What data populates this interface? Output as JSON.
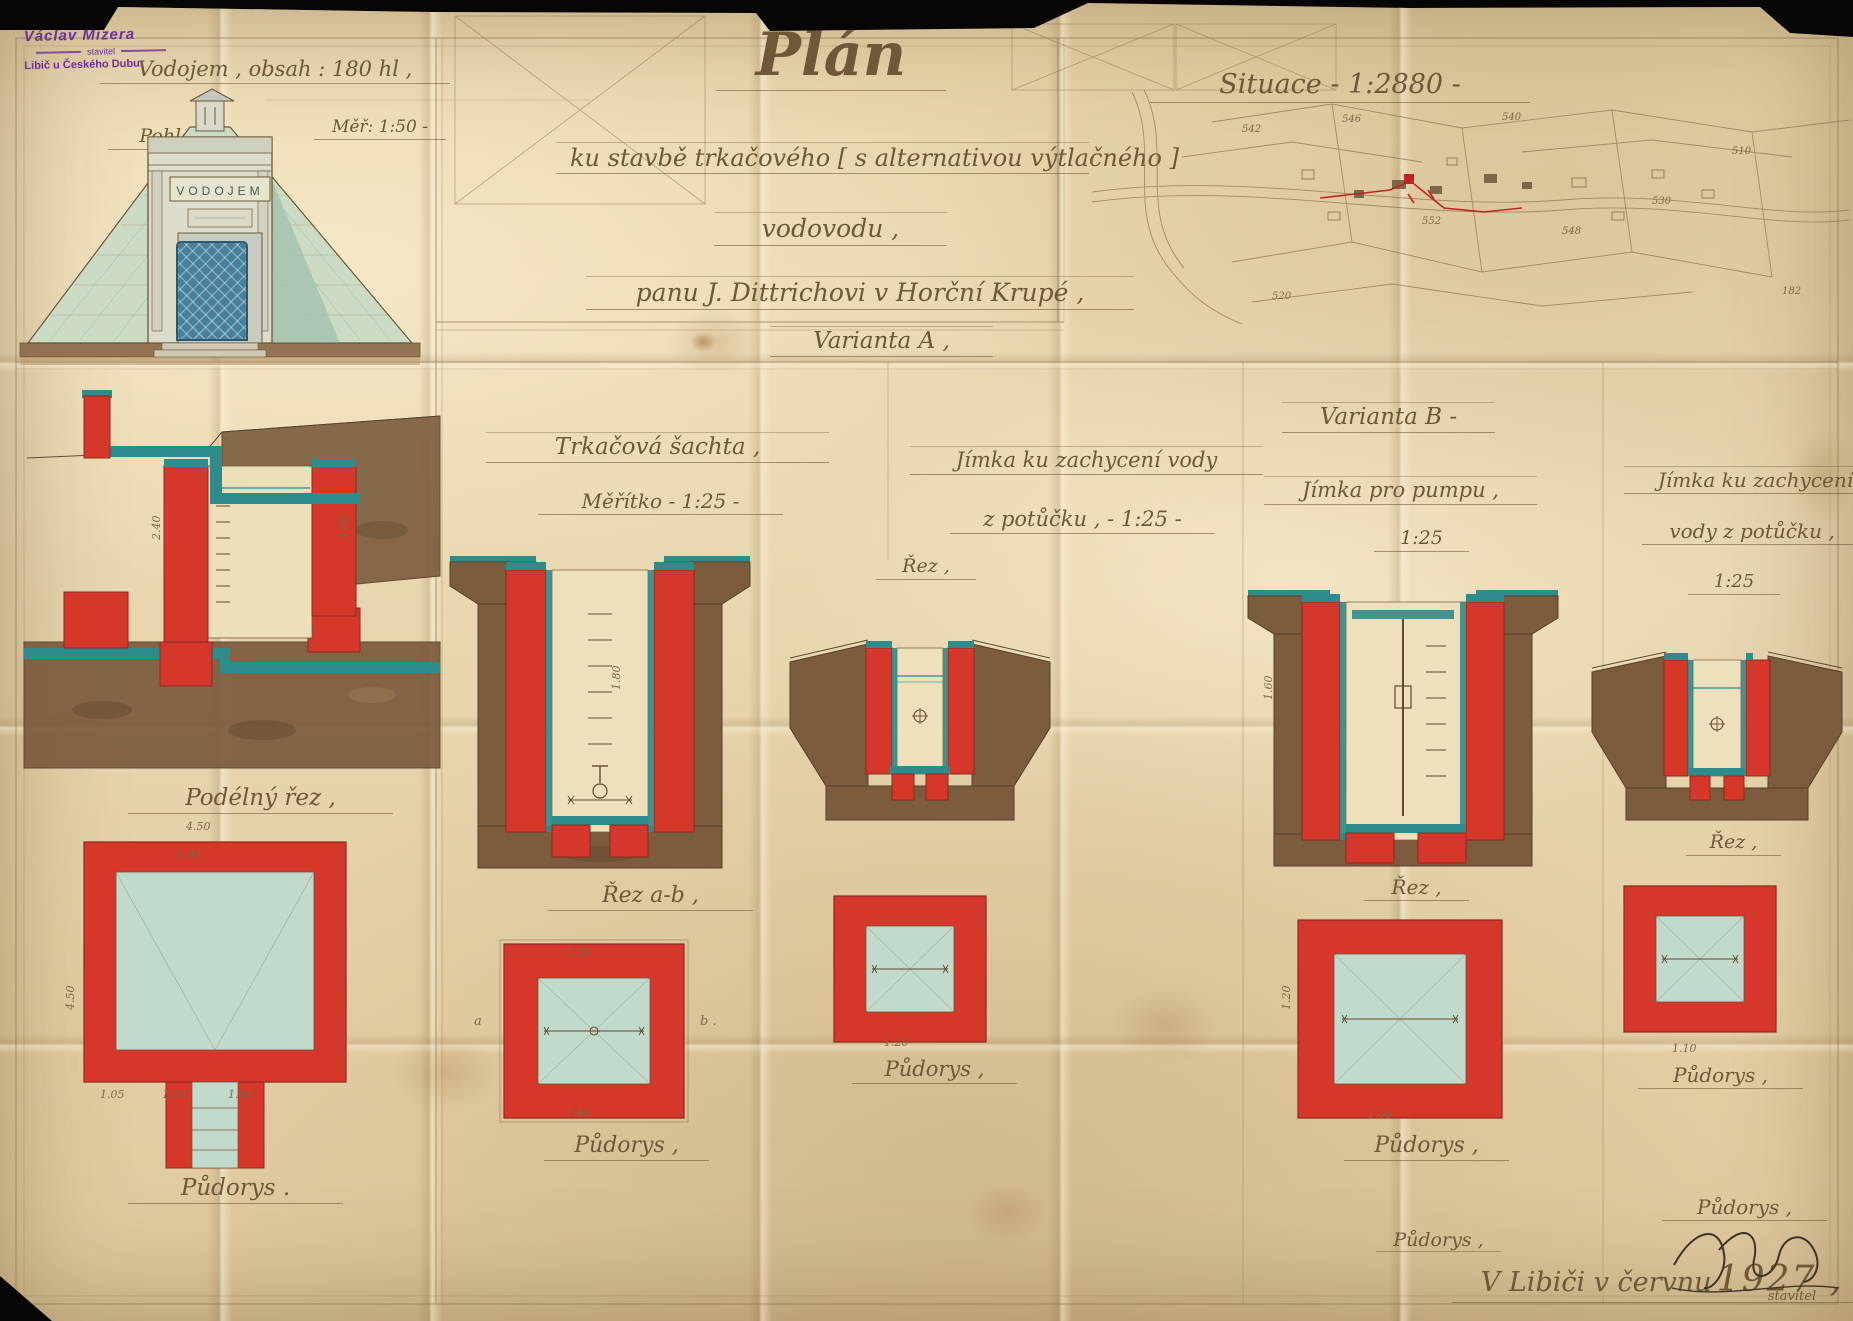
{
  "colors": {
    "red": "#d5382a",
    "teal": "#2f8c8c",
    "brown": "#7b5c3c",
    "interior_blue": "#c2dacc",
    "ink": "#6b573a",
    "stamp_violet": "#6d2f9e",
    "paper": "#e9d7b0"
  },
  "stamp": {
    "name": "Václav Mizera",
    "role": "stavitel",
    "place": "Libič u Českého Dubu."
  },
  "header_left": {
    "line1": "Vodojem , obsah : 180 hl ,",
    "line2": "Pohled ,",
    "scale": "Měř: 1:50 -",
    "sign": "VODOJEM"
  },
  "title_block": {
    "title": "Plán",
    "line1": "ku stavbě trkačového [ s alternativou výtlačného ]",
    "line2": "vodovodu ,",
    "line3": "panu J. Dittrichovi v Horční Krupé ,",
    "variant_a": "Varianta A ,"
  },
  "situation": {
    "title": "Situace - 1:2880 -",
    "numbers": [
      "542",
      "546",
      "540",
      "552",
      "548",
      "530",
      "510",
      "182",
      "520"
    ]
  },
  "col1": {
    "section_label": "Podélný řez ,",
    "plan_label": "Půdorys ."
  },
  "col2": {
    "title": "Trkačová šachta ,",
    "scale": "Měřítko - 1:25 -",
    "section_label": "Řez a-b ,",
    "plan_label": "Půdorys ,",
    "mark_a": "a",
    "mark_b": "b ."
  },
  "col3": {
    "title": "Jímka ku zachycení vody",
    "subtitle": "z potůčku , - 1:25 -",
    "section_label": "Řez ,",
    "plan_label": "Půdorys ,"
  },
  "col4": {
    "variant": "Varianta B -",
    "title": "Jímka pro pumpu ,",
    "scale": "1:25",
    "section_label": "Řez ,",
    "plan_label": "Půdorys ,"
  },
  "col5": {
    "title": "Jímka ku zachycení",
    "subtitle": "vody z potůčku ,",
    "scale": "1:25",
    "section_label": "Řez ,",
    "plan_label": "Půdorys ,",
    "plan_label2": "Půdorys ,"
  },
  "footer": {
    "date_text": "V Libiči v červnu",
    "date_year": "1927 ,",
    "signature_note": "stavitel"
  },
  "dims": {
    "d450": "4.50",
    "d300": "3.00",
    "d240": "2.40",
    "d180": "1.80",
    "d160": "1.60",
    "d140": "1.40",
    "d120": "1.20",
    "d110": "1.10",
    "d105": "1.05"
  }
}
